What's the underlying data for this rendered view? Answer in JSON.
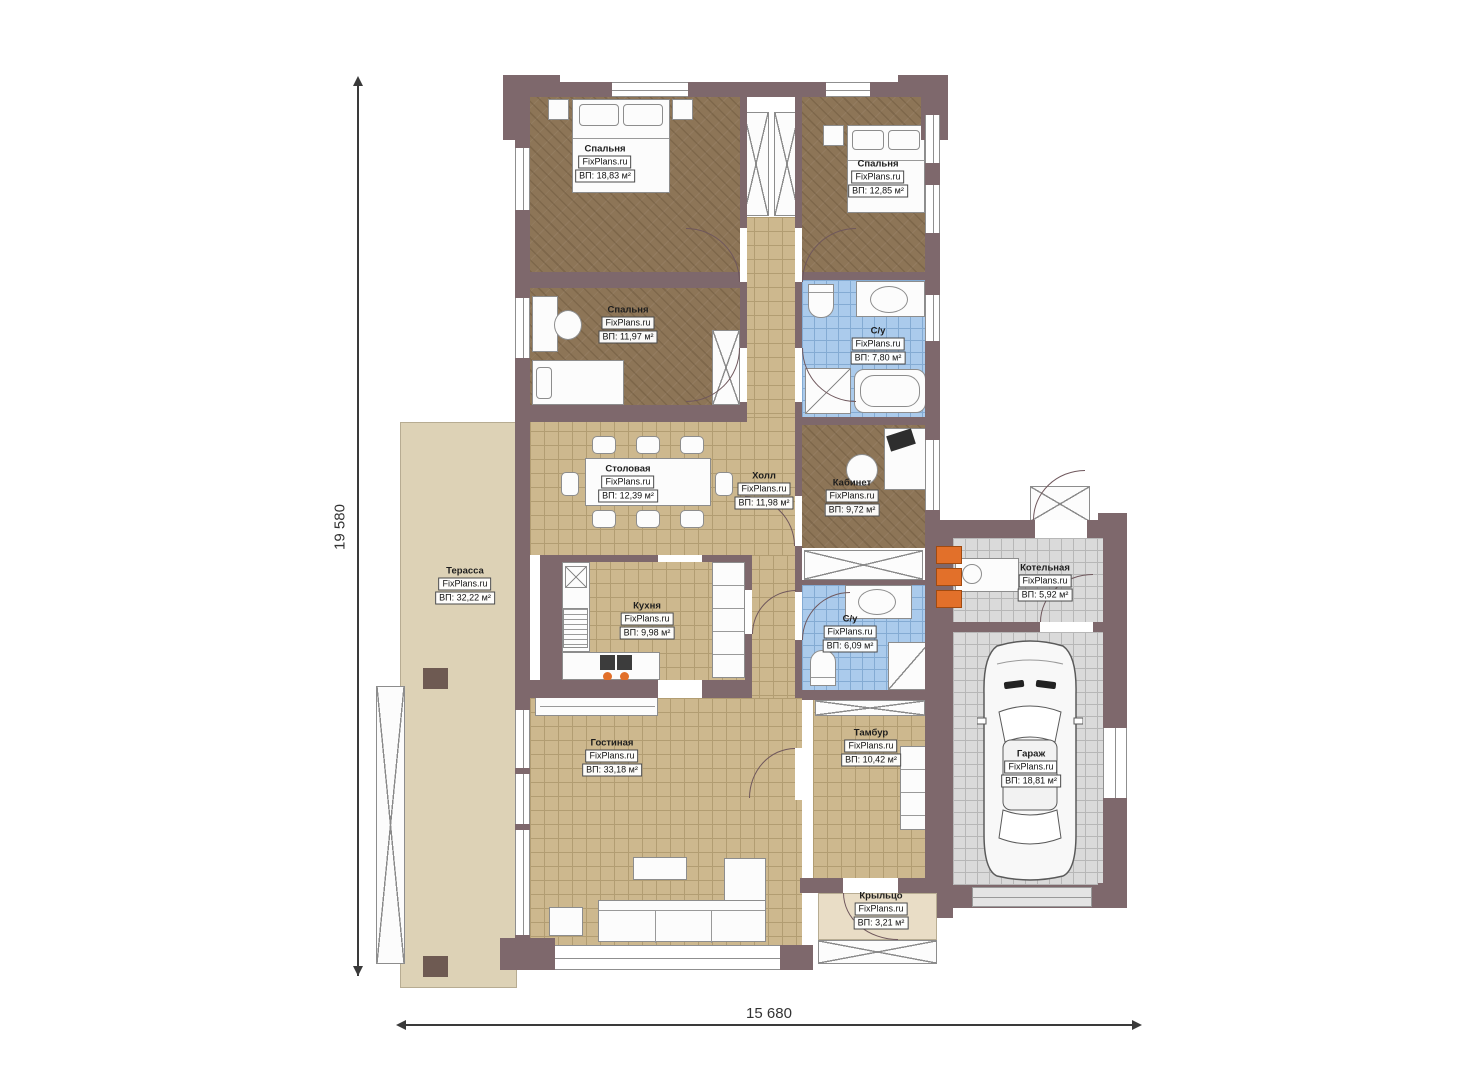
{
  "brand": "FixPlans.ru",
  "dimensions": {
    "height_label": "19 580",
    "width_label": "15 680"
  },
  "rooms": [
    {
      "name": "Спальня",
      "area": "ВП: 18,83 м²"
    },
    {
      "name": "Спальня",
      "area": "ВП: 12,85 м²"
    },
    {
      "name": "Спальня",
      "area": "ВП: 11,97 м²"
    },
    {
      "name": "С/у",
      "area": "ВП: 7,80 м²"
    },
    {
      "name": "Столовая",
      "area": "ВП: 12,39 м²"
    },
    {
      "name": "Холл",
      "area": "ВП: 11,98 м²"
    },
    {
      "name": "Кабинет",
      "area": "ВП: 9,72 м²"
    },
    {
      "name": "Кухня",
      "area": "ВП: 9,98 м²"
    },
    {
      "name": "С/у",
      "area": "ВП: 6,09 м²"
    },
    {
      "name": "Котельная",
      "area": "ВП: 5,92 м²"
    },
    {
      "name": "Терасса",
      "area": "ВП: 32,22 м²"
    },
    {
      "name": "Гостиная",
      "area": "ВП: 33,18 м²"
    },
    {
      "name": "Тамбур",
      "area": "ВП: 10,42 м²"
    },
    {
      "name": "Гараж",
      "area": "ВП: 18,81 м²"
    },
    {
      "name": "Крыльцо",
      "area": "ВП: 3,21 м²"
    }
  ],
  "colors": {
    "wall": "#7e686c",
    "bedroom_floor": "#8d7557",
    "tile_floor": "#cdb88e",
    "bathroom_floor": "#abcbec",
    "garage_floor": "#dadada",
    "terrace": "#ddd2b6",
    "accent_orange": "#e2702a"
  }
}
